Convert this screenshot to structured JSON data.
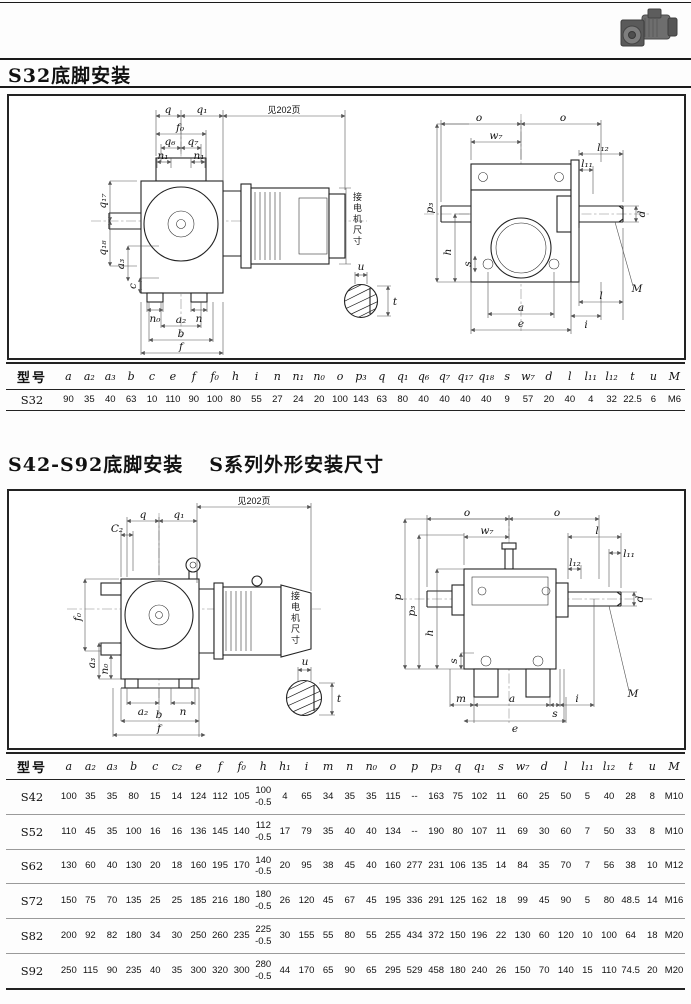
{
  "page": {
    "title1": "S32底脚安装",
    "title2a": "S42-S92底脚安装",
    "title2b": "S系列外形安装尺寸"
  },
  "labels": {
    "q": "q",
    "q1": "q₁",
    "q6": "q₆",
    "q7": "q₇",
    "q17": "q₁₇",
    "q18": "q₁₈",
    "n": "n",
    "n1": "n₁",
    "n0": "n₀",
    "m": "m",
    "a": "a",
    "a2": "a₂",
    "a3": "a₃",
    "b": "b",
    "c": "c",
    "c2": "C₂",
    "e": "e",
    "f": "f",
    "f0": "f₀",
    "h": "h",
    "h1": "h₁",
    "i": "i",
    "o": "o",
    "p": "p",
    "p3": "p₃",
    "s": "s",
    "w7": "w₇",
    "d": "d",
    "l": "l",
    "l11": "l₁₁",
    "l12": "l₁₂",
    "t": "t",
    "u": "u",
    "M": "M",
    "see_page": "见202页",
    "motor_dim": "接电机尺寸"
  },
  "table1": {
    "id_header": "型号",
    "columns": [
      "a",
      "a₂",
      "a₃",
      "b",
      "c",
      "e",
      "f",
      "f₀",
      "h",
      "i",
      "n",
      "n₁",
      "n₀",
      "o",
      "p₃",
      "q",
      "q₁",
      "q₆",
      "q₇",
      "q₁₇",
      "q₁₈",
      "s",
      "w₇",
      "d",
      "l",
      "l₁₁",
      "l₁₂",
      "t",
      "u",
      "M"
    ],
    "rows": [
      {
        "model": "S32",
        "values": [
          "90",
          "35",
          "40",
          "63",
          "10",
          "110",
          "90",
          "100",
          "80",
          "55",
          "27",
          "24",
          "20",
          "100",
          "143",
          "63",
          "80",
          "40",
          "40",
          "40",
          "40",
          "9",
          "57",
          "20",
          "40",
          "4",
          "32",
          "22.5",
          "6",
          "M6"
        ]
      }
    ]
  },
  "table2": {
    "id_header": "型号",
    "columns": [
      "a",
      "a₂",
      "a₃",
      "b",
      "c",
      "c₂",
      "e",
      "f",
      "f₀",
      "h",
      "h₁",
      "i",
      "m",
      "n",
      "n₀",
      "o",
      "p",
      "p₃",
      "q",
      "q₁",
      "s",
      "w₇",
      "d",
      "l",
      "l₁₁",
      "l₁₂",
      "t",
      "u",
      "M"
    ],
    "rows": [
      {
        "model": "S42",
        "values": [
          "100",
          "35",
          "35",
          "80",
          "15",
          "14",
          "124",
          "112",
          "105",
          "100\n-0.5",
          "4",
          "65",
          "34",
          "35",
          "35",
          "115",
          "--",
          "163",
          "75",
          "102",
          "11",
          "60",
          "25",
          "50",
          "5",
          "40",
          "28",
          "8",
          "M10"
        ]
      },
      {
        "model": "S52",
        "values": [
          "110",
          "45",
          "35",
          "100",
          "16",
          "16",
          "136",
          "145",
          "140",
          "112\n-0.5",
          "17",
          "79",
          "35",
          "40",
          "40",
          "134",
          "--",
          "190",
          "80",
          "107",
          "11",
          "69",
          "30",
          "60",
          "7",
          "50",
          "33",
          "8",
          "M10"
        ]
      },
      {
        "model": "S62",
        "values": [
          "130",
          "60",
          "40",
          "130",
          "20",
          "18",
          "160",
          "195",
          "170",
          "140\n-0.5",
          "20",
          "95",
          "38",
          "45",
          "40",
          "160",
          "277",
          "231",
          "106",
          "135",
          "14",
          "84",
          "35",
          "70",
          "7",
          "56",
          "38",
          "10",
          "M12"
        ]
      },
      {
        "model": "S72",
        "values": [
          "150",
          "75",
          "70",
          "135",
          "25",
          "25",
          "185",
          "216",
          "180",
          "180\n-0.5",
          "26",
          "120",
          "45",
          "67",
          "45",
          "195",
          "336",
          "291",
          "125",
          "162",
          "18",
          "99",
          "45",
          "90",
          "5",
          "80",
          "48.5",
          "14",
          "M16"
        ]
      },
      {
        "model": "S82",
        "values": [
          "200",
          "92",
          "82",
          "180",
          "34",
          "30",
          "250",
          "260",
          "235",
          "225\n-0.5",
          "30",
          "155",
          "55",
          "80",
          "55",
          "255",
          "434",
          "372",
          "150",
          "196",
          "22",
          "130",
          "60",
          "120",
          "10",
          "100",
          "64",
          "18",
          "M20"
        ]
      },
      {
        "model": "S92",
        "values": [
          "250",
          "115",
          "90",
          "235",
          "40",
          "35",
          "300",
          "320",
          "300",
          "280\n-0.5",
          "44",
          "170",
          "65",
          "90",
          "65",
          "295",
          "529",
          "458",
          "180",
          "240",
          "26",
          "150",
          "70",
          "140",
          "15",
          "110",
          "74.5",
          "20",
          "M20"
        ]
      }
    ]
  }
}
